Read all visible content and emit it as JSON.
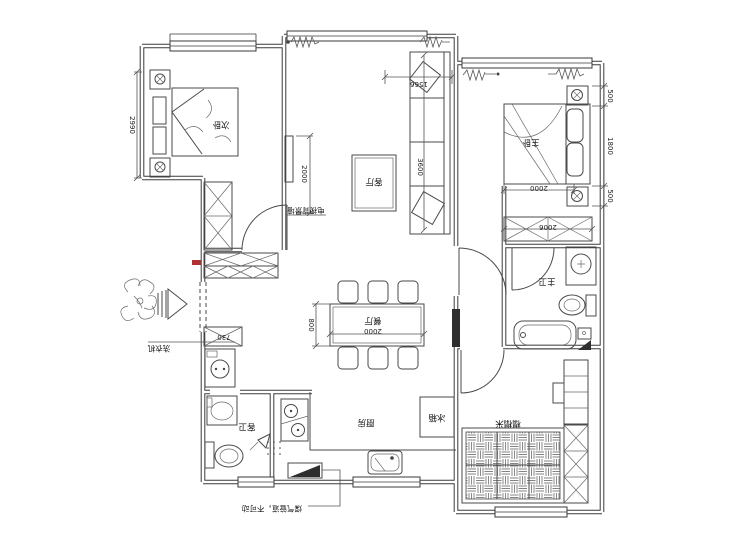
{
  "colors": {
    "line": "#3a3a3a",
    "accent_red": "#b03030",
    "background": "#ffffff"
  },
  "floorplan": {
    "rooms": {
      "secondary_bedroom": "次卧",
      "living_room": "客厅",
      "master_bedroom": "主卧",
      "master_bath": "主卫",
      "dining_room": "餐厅",
      "kitchen": "厨房",
      "guest_bath": "客卫",
      "tatami_room": "榻榻米"
    },
    "annotations": {
      "fridge": "冰箱",
      "washing_machine": "洗衣机",
      "tv_wall": "电视背景墙",
      "gas_note": "煤气管道，不可动"
    },
    "dimensions": {
      "bedroom2_depth": "2990",
      "living_window_width": "1566",
      "sofa_length": "3600",
      "tv_wall_width": "2000",
      "nightstand_top": "500",
      "master_bed_length": "1800",
      "nightstand_bottom": "500",
      "master_bed_width": "2000",
      "master_wardrobe_width": "2006",
      "dining_table_length": "2000",
      "dining_table_width": "800",
      "entry_cabinet_width": "730"
    }
  }
}
